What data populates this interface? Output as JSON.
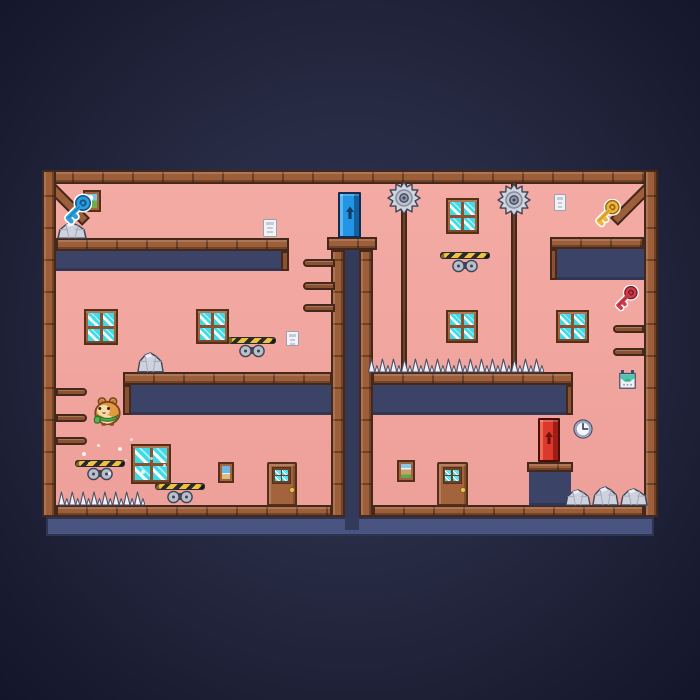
{
  "scene": {
    "description": "pixel-art platformer level: two pink rooms in a wooden frame separated by a central shaft with a blue exit door on top, a red exit door on a pedestal, collectible keys, saw hazards and spikes",
    "player": "hamster-with-green-scarf"
  },
  "palette": {
    "outer_bg": "#272b44",
    "room_pink": "#f1a59f",
    "wood": "#9d5e3a",
    "wood_dark": "#46281a",
    "wood_mid": "#8a5230",
    "slab_navy": "#3b4366",
    "shaft_navy": "#333a5a",
    "floor_slab": "#4a5480",
    "pane_cyan": "#3fd9e7",
    "saw_gray": "#d0d5e0",
    "spike_white": "#eef1f7",
    "hazard_yellow": "#eec23f",
    "door_blue": "#2395e4",
    "door_red": "#dc382b",
    "key_blue": "#2ba0dc",
    "key_yellow": "#f0b43c",
    "key_red": "#d13c4c",
    "scarf_green": "#56b54a",
    "hamster_orange": "#e2993f"
  },
  "level": {
    "sprites": [
      {
        "type": "rail",
        "name": "saw-rail-left",
        "x": 401,
        "y": 183,
        "w": 6,
        "h": 190
      },
      {
        "type": "rail",
        "name": "saw-rail-right",
        "x": 511,
        "y": 183,
        "w": 6,
        "h": 190
      },
      {
        "type": "saw",
        "name": "saw-blade-left",
        "x": 387,
        "y": 181,
        "w": 34,
        "h": 34
      },
      {
        "type": "saw",
        "name": "saw-blade-right",
        "x": 497,
        "y": 183,
        "w": 34,
        "h": 34
      },
      {
        "type": "hazard-bar",
        "name": "hazard-bar",
        "x": 440,
        "y": 252,
        "w": 50,
        "h": 7
      },
      {
        "type": "hazard-bar",
        "name": "hazard-bar",
        "x": 228,
        "y": 337,
        "w": 48,
        "h": 7
      },
      {
        "type": "hazard-bar",
        "name": "hazard-bar",
        "x": 75,
        "y": 460,
        "w": 50,
        "h": 7
      },
      {
        "type": "hazard-bar",
        "name": "hazard-bar",
        "x": 155,
        "y": 483,
        "w": 50,
        "h": 7
      },
      {
        "type": "window",
        "name": "window",
        "x": 84,
        "y": 309,
        "w": 34,
        "h": 36
      },
      {
        "type": "window",
        "name": "window",
        "x": 196,
        "y": 309,
        "w": 33,
        "h": 35
      },
      {
        "type": "window",
        "name": "window",
        "x": 446,
        "y": 198,
        "w": 33,
        "h": 36
      },
      {
        "type": "window",
        "name": "window",
        "x": 446,
        "y": 310,
        "w": 32,
        "h": 33
      },
      {
        "type": "window",
        "name": "window",
        "x": 556,
        "y": 310,
        "w": 33,
        "h": 33
      },
      {
        "type": "window",
        "name": "window-large",
        "x": 131,
        "y": 444,
        "w": 40,
        "h": 40
      },
      {
        "type": "painting",
        "variant": "landscape",
        "name": "painting-landscape",
        "x": 83,
        "y": 190,
        "w": 18,
        "h": 22
      },
      {
        "type": "painting",
        "variant": "beach",
        "name": "painting-beach",
        "x": 218,
        "y": 462,
        "w": 16,
        "h": 21
      },
      {
        "type": "painting",
        "variant": "mountain",
        "name": "painting-mountain",
        "x": 397,
        "y": 460,
        "w": 18,
        "h": 22
      },
      {
        "type": "sign",
        "name": "hanging-sign",
        "x": 619,
        "y": 370,
        "w": 17,
        "h": 19
      },
      {
        "type": "note",
        "name": "note-paper",
        "x": 263,
        "y": 219,
        "w": 14,
        "h": 18
      },
      {
        "type": "note",
        "name": "note-paper",
        "x": 286,
        "y": 331,
        "w": 13,
        "h": 15
      },
      {
        "type": "note",
        "name": "note-paper",
        "x": 554,
        "y": 194,
        "w": 12,
        "h": 17
      },
      {
        "type": "ledge",
        "name": "ledge",
        "x": 303,
        "y": 259,
        "w": 32,
        "h": 8,
        "round": "left"
      },
      {
        "type": "ledge",
        "name": "ledge",
        "x": 303,
        "y": 282,
        "w": 32,
        "h": 8,
        "round": "left"
      },
      {
        "type": "ledge",
        "name": "ledge",
        "x": 303,
        "y": 304,
        "w": 32,
        "h": 8,
        "round": "left"
      },
      {
        "type": "ledge",
        "name": "ledge",
        "x": 56,
        "y": 388,
        "w": 31,
        "h": 8,
        "round": "right"
      },
      {
        "type": "ledge",
        "name": "ledge",
        "x": 56,
        "y": 414,
        "w": 31,
        "h": 8,
        "round": "right"
      },
      {
        "type": "ledge",
        "name": "ledge",
        "x": 56,
        "y": 437,
        "w": 31,
        "h": 8,
        "round": "right"
      },
      {
        "type": "ledge",
        "name": "ledge",
        "x": 613,
        "y": 325,
        "w": 31,
        "h": 8,
        "round": "left"
      },
      {
        "type": "ledge",
        "name": "ledge",
        "x": 613,
        "y": 348,
        "w": 31,
        "h": 8,
        "round": "left"
      },
      {
        "type": "spike-row",
        "name": "floor-spikes",
        "x": 58,
        "y": 491,
        "w": 87,
        "h": 15,
        "count": 8
      },
      {
        "type": "spike-row",
        "name": "platform-spikes",
        "x": 368,
        "y": 358,
        "w": 176,
        "h": 15,
        "count": 16
      },
      {
        "type": "rock",
        "name": "rock",
        "x": 57,
        "y": 222,
        "w": 30,
        "h": 17
      },
      {
        "type": "rock",
        "name": "rock",
        "x": 137,
        "y": 352,
        "w": 27,
        "h": 21
      },
      {
        "type": "rock",
        "name": "rock",
        "x": 565,
        "y": 489,
        "w": 26,
        "h": 17
      },
      {
        "type": "rock",
        "name": "rock",
        "x": 592,
        "y": 486,
        "w": 27,
        "h": 20
      },
      {
        "type": "rock",
        "name": "rock",
        "x": 620,
        "y": 488,
        "w": 28,
        "h": 18
      },
      {
        "type": "wood-door",
        "name": "wooden-door",
        "x": 267,
        "y": 462,
        "w": 30,
        "h": 44
      },
      {
        "type": "wood-door",
        "name": "wooden-door",
        "x": 437,
        "y": 462,
        "w": 31,
        "h": 44
      },
      {
        "type": "exit-door",
        "color": "blue",
        "name": "blue-exit-door",
        "x": 338,
        "y": 192,
        "w": 23,
        "h": 46
      },
      {
        "type": "exit-door",
        "color": "red",
        "name": "red-exit-door",
        "x": 538,
        "y": 418,
        "w": 22,
        "h": 44
      },
      {
        "type": "clock",
        "name": "wall-clock",
        "x": 573,
        "y": 419,
        "w": 20,
        "h": 20
      },
      {
        "type": "key",
        "color": "blue",
        "name": "blue-key",
        "x": 60,
        "y": 192,
        "w": 32,
        "h": 36
      },
      {
        "type": "key",
        "color": "yellow",
        "name": "yellow-key",
        "x": 591,
        "y": 199,
        "w": 30,
        "h": 29
      },
      {
        "type": "key",
        "color": "red",
        "name": "red-key",
        "x": 611,
        "y": 285,
        "w": 28,
        "h": 27
      },
      {
        "type": "hamster",
        "name": "hamster-player",
        "x": 92,
        "y": 395,
        "w": 31,
        "h": 31
      }
    ],
    "particles": [
      {
        "x": 82,
        "y": 452,
        "s": 4,
        "o": 0.9
      },
      {
        "x": 97,
        "y": 444,
        "s": 3,
        "o": 0.8
      },
      {
        "x": 118,
        "y": 447,
        "s": 4,
        "o": 0.85
      },
      {
        "x": 150,
        "y": 457,
        "s": 3,
        "o": 0.7
      },
      {
        "x": 141,
        "y": 470,
        "s": 4,
        "o": 0.8
      },
      {
        "x": 108,
        "y": 472,
        "s": 3,
        "o": 0.7
      },
      {
        "x": 130,
        "y": 438,
        "s": 3,
        "o": 0.6
      },
      {
        "x": 163,
        "y": 464,
        "s": 3,
        "o": 0.75
      },
      {
        "x": 88,
        "y": 462,
        "s": 2,
        "o": 0.6
      },
      {
        "x": 125,
        "y": 459,
        "s": 2,
        "o": 0.5
      }
    ]
  }
}
